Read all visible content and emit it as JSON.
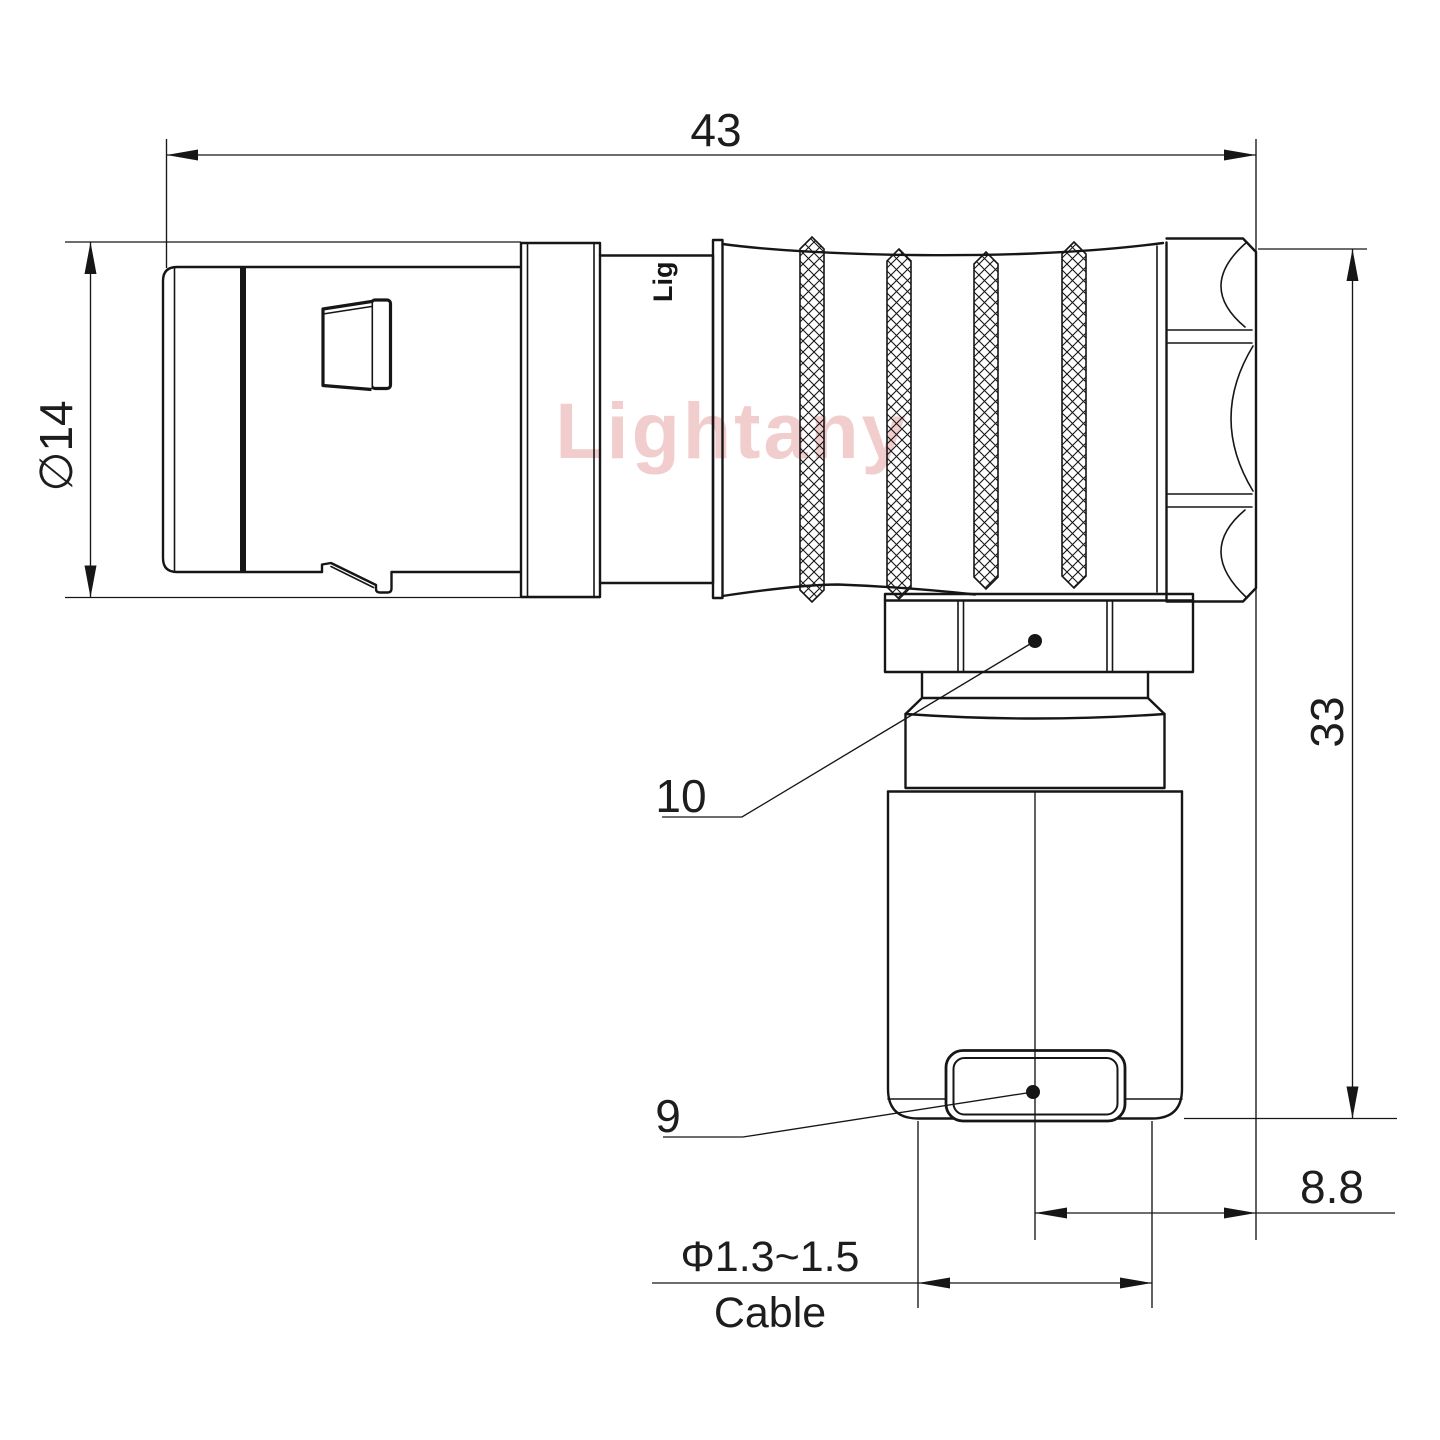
{
  "page": {
    "type": "technical-drawing",
    "background": "#ffffff",
    "line_color": "#161616",
    "watermark_color": "#f1cdcd"
  },
  "watermark": {
    "text": "Lightany"
  },
  "engraving": {
    "text": "Lig"
  },
  "dimensions": {
    "overall_length": {
      "value": "43"
    },
    "front_diameter": {
      "value": "∅14"
    },
    "overall_height": {
      "value": "33"
    },
    "rear_offset": {
      "value": "8.8"
    },
    "cable_range": {
      "value": "Φ1.3~1.5"
    },
    "cable_label": {
      "value": "Cable"
    }
  },
  "callouts": {
    "coupling_nut": {
      "value": "10"
    },
    "cable_clamp": {
      "value": "9"
    }
  }
}
